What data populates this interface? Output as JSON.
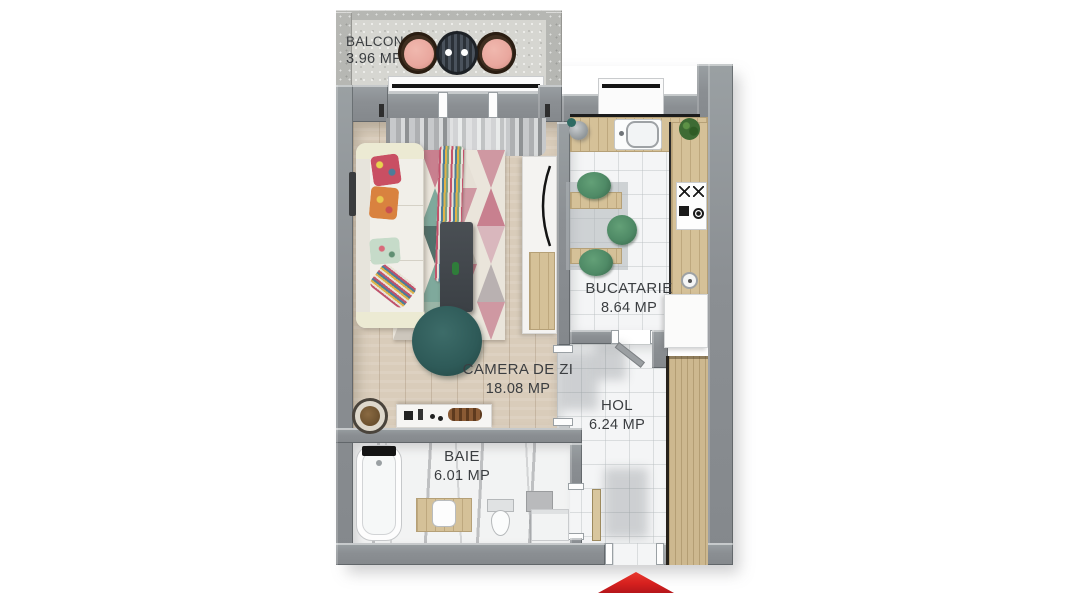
{
  "floor_plan": {
    "rooms": [
      {
        "id": "balcon",
        "label": "BALCON",
        "area": "3.96 MP"
      },
      {
        "id": "bucatarie",
        "label": "BUCATARIE",
        "area": "8.64 MP"
      },
      {
        "id": "camera-de-zi",
        "label": "CAMERA DE ZI",
        "area": "18.08 MP"
      },
      {
        "id": "hol",
        "label": "HOL",
        "area": "6.24 MP"
      },
      {
        "id": "baie",
        "label": "BAIE",
        "area": "6.01 MP"
      }
    ],
    "entrance_marker": {
      "icon": "entrance-arrow-icon",
      "direction": "up",
      "color": "#d6201e"
    },
    "palette": {
      "wall_gray": "#8e9296",
      "balcony_wall_gray": "#b6b7b3",
      "wood_floor": "#d9ccba",
      "tile_white": "#f4f5f6",
      "counter_wood": "#d5c198",
      "wardrobe_wood": "#cdb88f",
      "rug_pink": "#cf98a2",
      "rug_rose": "#c8808f",
      "rug_teal": "#7fa99c",
      "pouf_teal": "#2e5a58",
      "kitchen_chair_green": "#4f8a66",
      "balcony_cushion_pink": "#e9a79e",
      "entrance_arrow_red": "#d6201e"
    }
  }
}
